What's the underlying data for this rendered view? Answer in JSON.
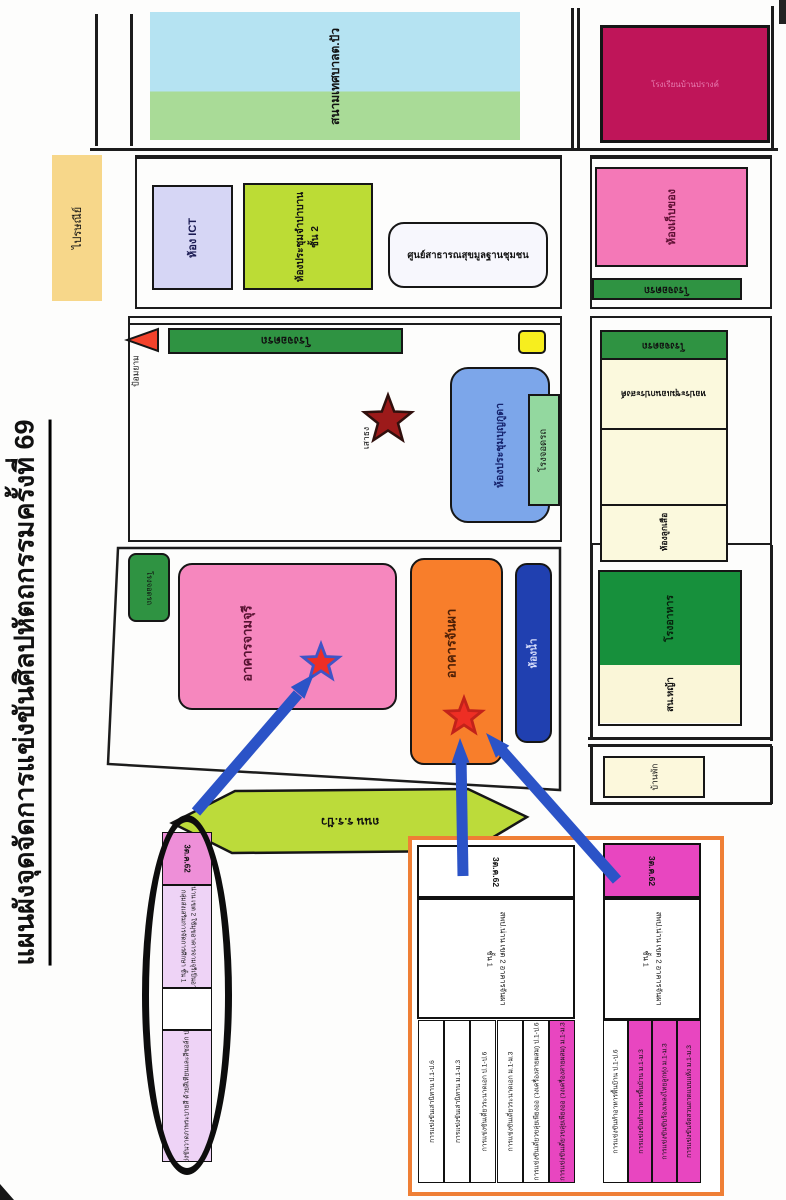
{
  "title": "แผนผังจุดจัดการแข่งขันศิลปหัตถกรรมครั้งที่ 69",
  "map": {
    "stadium_label": "สนามเทศบาลต.ปัว",
    "school_sign": "โรงเรียนบ้านปรางค์",
    "post_office": "ไปรษณีย์",
    "ict_room": "ห้อง ICT",
    "meeting_room_champa": "ห้องประชุมจำปาบาน",
    "meeting_room_champa_floor": "ชั้น 2",
    "health_center": "ศูนย์สาธารณสุขมูลฐานชุมชน",
    "parking": "โรงจอดรถ",
    "guard_post": "ป้อมยาม",
    "flagpole": "เสาธง",
    "meeting_room_boonkuda": "ห้องประชุมบุญกูดา",
    "storage_room": "ห้องเก็บของ",
    "multipurpose_hall": "หอประชุมเอนกประสงค์",
    "scout_room": "ห้องลูกเสือ",
    "cafeteria": "โรงอาหาร",
    "lawn": "สน.หญ้า",
    "residence": "บ้านพัก",
    "building_jamjuree": "อาคารจามจุรี",
    "building_janpha": "อาคารจันผา",
    "restroom": "ห้องน้ำ",
    "road": "ถนน ร.ร.ปัว"
  },
  "ellipse_table": {
    "date": "3ต.ค.62",
    "location_line1": "สพป.น่าน เขต 2 ใช้มุขอาคารจามจุรีเป็นอาคาร",
    "location_line2": "กลุ่มส่งเสริมการจัดการศึกษา ชั้น 1",
    "event": "การแข่งขันวาดภาพระบายสี ด้วยสีเทียนและสีชอล์ก ป.1-ป.3"
  },
  "tables": {
    "left": {
      "date": "3ต.ค.62",
      "location_line1": "สพป.น่าน เขต 2 อาคารจันผา",
      "location_line2": "ชั้น 1",
      "rows": [
        {
          "text": "การแข่งขันเล่านิทาน ป.1-ป.6",
          "highlight": false
        },
        {
          "text": "การแข่งขันเล่านิทาน ม.1-ม.3",
          "highlight": false
        },
        {
          "text": "การแข่งขันเดี่ยวระนาดเอก ป.1-ป.6",
          "highlight": false
        },
        {
          "text": "การแข่งขันเดี่ยวระนาดเอก ม.1-ม.3",
          "highlight": false
        },
        {
          "text": "การแข่งขันเดี่ยวขลุ่ยเพียงออ (วงเครื่องสายผสม) ป.1-ป.6",
          "highlight": false
        },
        {
          "text": "การแข่งขันเดี่ยวขลุ่ยเพียงออ (วงเครื่องสายผสม) ม.1-ม.3",
          "highlight": true
        }
      ]
    },
    "right": {
      "date": "3ต.ค.62",
      "location_line1": "สพป.น่าน เขต 2 อาคารจันผา",
      "location_line2": "ชั้น 1",
      "rows": [
        {
          "text": "การแข่งขันทำอาหารพื้นบ้าน ป.1-ป.6",
          "highlight": false
        },
        {
          "text": "การแข่งขันทำอาหารพื้นบ้าน ม.1-ม.3",
          "highlight": true
        },
        {
          "text": "การแข่งขันขับร้องเพลงไทยลูกทุ่ง ม.1-ม.3",
          "highlight": true
        },
        {
          "text": "การแข่งขันจัดสวนถาดแบบแห้ง ม.1-ม.3",
          "highlight": true
        }
      ]
    }
  },
  "colors": {
    "arrow_blue": "#2b53c7",
    "highlight_magenta": "#e846c0",
    "frame_orange": "#ef7f35",
    "star_red": "#ee2e24",
    "parking_green": "#2f9342"
  }
}
